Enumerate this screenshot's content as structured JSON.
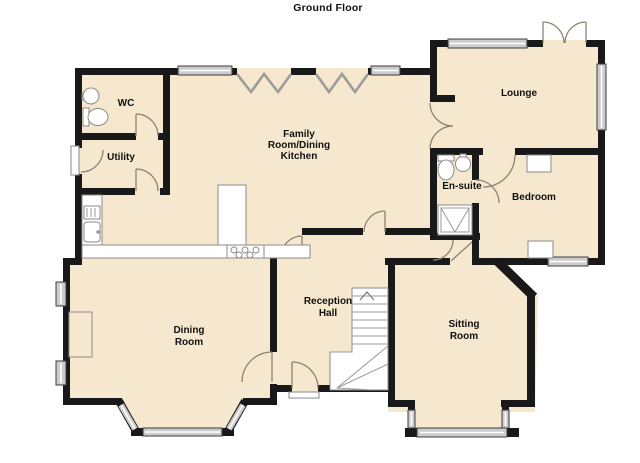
{
  "title": "Ground Floor",
  "colors": {
    "page_background": "#FFFFFF",
    "floor_fill": "#F6E8CF",
    "wall": "#191919",
    "window_bar": "#CCCCCC",
    "door_arc": "#8D8372",
    "label_text": "#111111"
  },
  "rooms": {
    "wc": {
      "lines": [
        "WC"
      ]
    },
    "utility": {
      "lines": [
        "Utility"
      ]
    },
    "family_kitchen": {
      "lines": [
        "Family",
        "Room/Dining",
        "Kitchen"
      ]
    },
    "lounge": {
      "lines": [
        "Lounge"
      ]
    },
    "ensuite": {
      "lines": [
        "En-suite"
      ]
    },
    "bedroom": {
      "lines": [
        "Bedroom"
      ]
    },
    "dining": {
      "lines": [
        "Dining",
        "Room"
      ]
    },
    "reception": {
      "lines": [
        "Reception",
        "Hall"
      ]
    },
    "sitting": {
      "lines": [
        "Sitting",
        "Room"
      ]
    }
  },
  "fixtures": [
    "wc-basin",
    "wc-toilet",
    "utility-side-door",
    "kitchen-counter",
    "kitchen-sink",
    "kitchen-drainer",
    "kitchen-hob",
    "kitchen-unit",
    "ensuite-toilet",
    "ensuite-basin",
    "ensuite-shower",
    "bedroom-wardrobe",
    "dining-fireplace",
    "stairs",
    "front-door-threshold",
    "lounge-french-doors",
    "bifold-doors",
    "bay-window-dining",
    "bay-window-sitting"
  ]
}
